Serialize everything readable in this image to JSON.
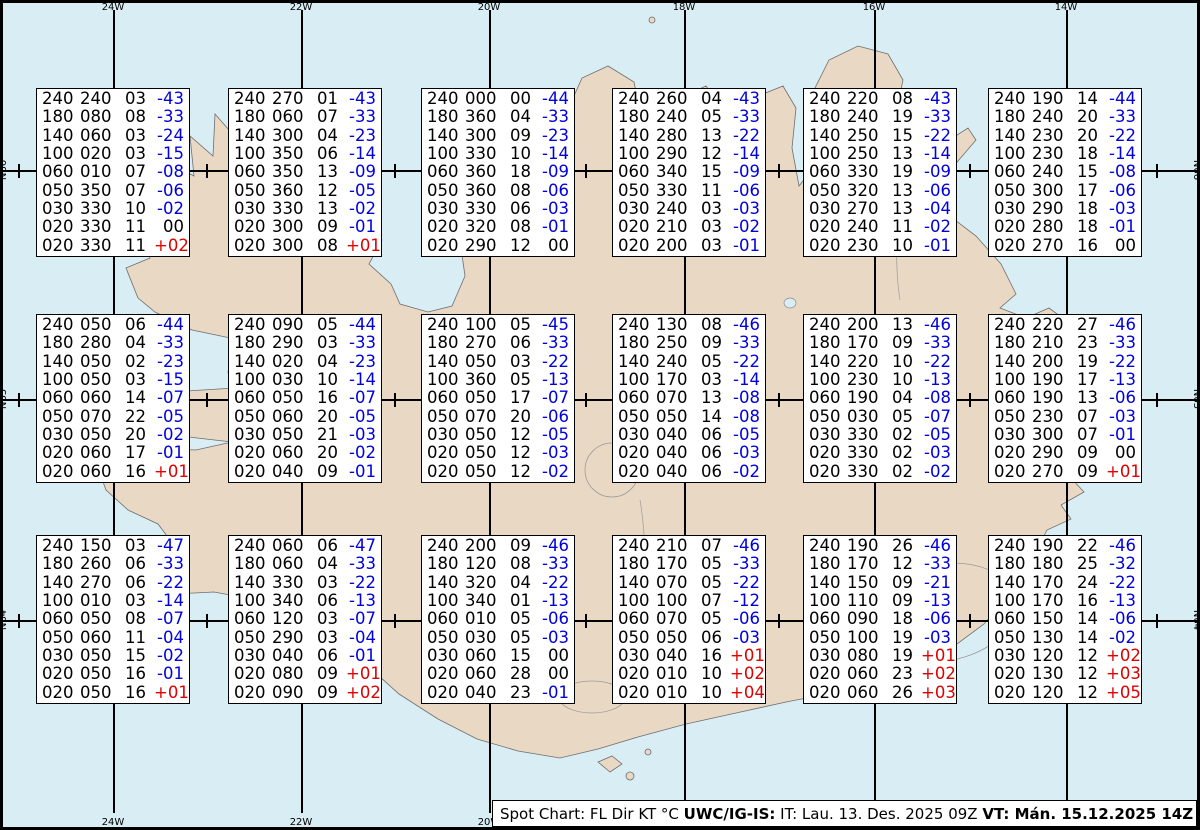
{
  "title": "Spot Chart FL Dir KT C - Iceland",
  "colors": {
    "water": "#d9edf4",
    "land": "#e9d9c4",
    "coast": "#6e6e6e",
    "line": "#000000",
    "box_background": "#ffffff",
    "temp_negative_blue": "#0000dd",
    "temp_positive_red": "#dd0000",
    "text_black": "#000000"
  },
  "graticule": {
    "meridians": [
      {
        "label": "24W",
        "x": 113
      },
      {
        "label": "22W",
        "x": 301
      },
      {
        "label": "20W",
        "x": 489
      },
      {
        "label": "18W",
        "x": 684
      },
      {
        "label": "16W",
        "x": 874
      },
      {
        "label": "14W",
        "x": 1066
      }
    ],
    "parallels": [
      {
        "label": "N66",
        "y": 170
      },
      {
        "label": "N65",
        "y": 399
      },
      {
        "label": "N64",
        "y": 620
      }
    ],
    "minor_tick_x": [
      19,
      207,
      395,
      586,
      779,
      970,
      1157
    ]
  },
  "boxes": [
    {
      "id": "r1c1",
      "x": 36,
      "y": 88,
      "rows": [
        [
          "240",
          "240",
          "03",
          "-43"
        ],
        [
          "180",
          "080",
          "08",
          "-33"
        ],
        [
          "140",
          "060",
          "03",
          "-24"
        ],
        [
          "100",
          "020",
          "03",
          "-15"
        ],
        [
          "060",
          "010",
          "07",
          "-08"
        ],
        [
          "050",
          "350",
          "07",
          "-06"
        ],
        [
          "030",
          "330",
          "10",
          "-02"
        ],
        [
          "020",
          "330",
          "11",
          "00"
        ],
        [
          "020",
          "330",
          "11",
          "+02"
        ]
      ]
    },
    {
      "id": "r1c2",
      "x": 228,
      "y": 88,
      "rows": [
        [
          "240",
          "270",
          "01",
          "-43"
        ],
        [
          "180",
          "060",
          "07",
          "-33"
        ],
        [
          "140",
          "300",
          "04",
          "-23"
        ],
        [
          "100",
          "350",
          "06",
          "-14"
        ],
        [
          "060",
          "350",
          "13",
          "-09"
        ],
        [
          "050",
          "360",
          "12",
          "-05"
        ],
        [
          "030",
          "330",
          "13",
          "-02"
        ],
        [
          "020",
          "300",
          "09",
          "-01"
        ],
        [
          "020",
          "300",
          "08",
          "+01"
        ]
      ]
    },
    {
      "id": "r1c3",
      "x": 421,
      "y": 88,
      "rows": [
        [
          "240",
          "000",
          "00",
          "-44"
        ],
        [
          "180",
          "360",
          "04",
          "-33"
        ],
        [
          "140",
          "300",
          "09",
          "-23"
        ],
        [
          "100",
          "330",
          "10",
          "-14"
        ],
        [
          "060",
          "360",
          "18",
          "-09"
        ],
        [
          "050",
          "360",
          "08",
          "-06"
        ],
        [
          "030",
          "330",
          "06",
          "-03"
        ],
        [
          "020",
          "320",
          "08",
          "-01"
        ],
        [
          "020",
          "290",
          "12",
          "00"
        ]
      ]
    },
    {
      "id": "r1c4",
      "x": 612,
      "y": 88,
      "rows": [
        [
          "240",
          "260",
          "04",
          "-43"
        ],
        [
          "180",
          "240",
          "05",
          "-33"
        ],
        [
          "140",
          "280",
          "13",
          "-22"
        ],
        [
          "100",
          "290",
          "12",
          "-14"
        ],
        [
          "060",
          "340",
          "15",
          "-09"
        ],
        [
          "050",
          "330",
          "11",
          "-06"
        ],
        [
          "030",
          "240",
          "03",
          "-03"
        ],
        [
          "020",
          "210",
          "03",
          "-02"
        ],
        [
          "020",
          "200",
          "03",
          "-01"
        ]
      ]
    },
    {
      "id": "r1c5",
      "x": 803,
      "y": 88,
      "rows": [
        [
          "240",
          "220",
          "08",
          "-43"
        ],
        [
          "180",
          "240",
          "19",
          "-33"
        ],
        [
          "140",
          "250",
          "15",
          "-22"
        ],
        [
          "100",
          "250",
          "13",
          "-14"
        ],
        [
          "060",
          "330",
          "19",
          "-09"
        ],
        [
          "050",
          "320",
          "13",
          "-06"
        ],
        [
          "030",
          "270",
          "13",
          "-04"
        ],
        [
          "020",
          "240",
          "11",
          "-02"
        ],
        [
          "020",
          "230",
          "10",
          "-01"
        ]
      ]
    },
    {
      "id": "r1c6",
      "x": 988,
      "y": 88,
      "rows": [
        [
          "240",
          "190",
          "14",
          "-44"
        ],
        [
          "180",
          "240",
          "20",
          "-33"
        ],
        [
          "140",
          "230",
          "20",
          "-22"
        ],
        [
          "100",
          "230",
          "18",
          "-14"
        ],
        [
          "060",
          "240",
          "15",
          "-08"
        ],
        [
          "050",
          "300",
          "17",
          "-06"
        ],
        [
          "030",
          "290",
          "18",
          "-03"
        ],
        [
          "020",
          "280",
          "18",
          "-01"
        ],
        [
          "020",
          "270",
          "16",
          "00"
        ]
      ]
    },
    {
      "id": "r2c1",
      "x": 36,
      "y": 314,
      "rows": [
        [
          "240",
          "050",
          "06",
          "-44"
        ],
        [
          "180",
          "280",
          "04",
          "-33"
        ],
        [
          "140",
          "050",
          "02",
          "-23"
        ],
        [
          "100",
          "050",
          "03",
          "-15"
        ],
        [
          "060",
          "060",
          "14",
          "-07"
        ],
        [
          "050",
          "070",
          "22",
          "-05"
        ],
        [
          "030",
          "050",
          "20",
          "-02"
        ],
        [
          "020",
          "060",
          "17",
          "-01"
        ],
        [
          "020",
          "060",
          "16",
          "+01"
        ]
      ]
    },
    {
      "id": "r2c2",
      "x": 228,
      "y": 314,
      "rows": [
        [
          "240",
          "090",
          "05",
          "-44"
        ],
        [
          "180",
          "290",
          "03",
          "-33"
        ],
        [
          "140",
          "020",
          "04",
          "-23"
        ],
        [
          "100",
          "030",
          "10",
          "-14"
        ],
        [
          "060",
          "050",
          "16",
          "-07"
        ],
        [
          "050",
          "060",
          "20",
          "-05"
        ],
        [
          "030",
          "050",
          "21",
          "-03"
        ],
        [
          "020",
          "060",
          "20",
          "-02"
        ],
        [
          "020",
          "040",
          "09",
          "-01"
        ]
      ]
    },
    {
      "id": "r2c3",
      "x": 421,
      "y": 314,
      "rows": [
        [
          "240",
          "100",
          "05",
          "-45"
        ],
        [
          "180",
          "270",
          "06",
          "-33"
        ],
        [
          "140",
          "050",
          "03",
          "-22"
        ],
        [
          "100",
          "360",
          "05",
          "-13"
        ],
        [
          "060",
          "050",
          "17",
          "-07"
        ],
        [
          "050",
          "070",
          "20",
          "-06"
        ],
        [
          "030",
          "050",
          "12",
          "-05"
        ],
        [
          "020",
          "050",
          "12",
          "-03"
        ],
        [
          "020",
          "050",
          "12",
          "-02"
        ]
      ]
    },
    {
      "id": "r2c4",
      "x": 612,
      "y": 314,
      "rows": [
        [
          "240",
          "130",
          "08",
          "-46"
        ],
        [
          "180",
          "250",
          "09",
          "-33"
        ],
        [
          "140",
          "240",
          "05",
          "-22"
        ],
        [
          "100",
          "170",
          "03",
          "-14"
        ],
        [
          "060",
          "070",
          "13",
          "-08"
        ],
        [
          "050",
          "050",
          "14",
          "-08"
        ],
        [
          "030",
          "040",
          "06",
          "-05"
        ],
        [
          "020",
          "040",
          "06",
          "-03"
        ],
        [
          "020",
          "040",
          "06",
          "-02"
        ]
      ]
    },
    {
      "id": "r2c5",
      "x": 803,
      "y": 314,
      "rows": [
        [
          "240",
          "200",
          "13",
          "-46"
        ],
        [
          "180",
          "170",
          "09",
          "-33"
        ],
        [
          "140",
          "220",
          "10",
          "-22"
        ],
        [
          "100",
          "230",
          "10",
          "-13"
        ],
        [
          "060",
          "190",
          "04",
          "-08"
        ],
        [
          "050",
          "030",
          "05",
          "-07"
        ],
        [
          "030",
          "330",
          "02",
          "-05"
        ],
        [
          "020",
          "330",
          "02",
          "-03"
        ],
        [
          "020",
          "330",
          "02",
          "-02"
        ]
      ]
    },
    {
      "id": "r2c6",
      "x": 988,
      "y": 314,
      "rows": [
        [
          "240",
          "220",
          "27",
          "-46"
        ],
        [
          "180",
          "210",
          "23",
          "-33"
        ],
        [
          "140",
          "200",
          "19",
          "-22"
        ],
        [
          "100",
          "190",
          "17",
          "-13"
        ],
        [
          "060",
          "190",
          "13",
          "-06"
        ],
        [
          "050",
          "230",
          "07",
          "-03"
        ],
        [
          "030",
          "300",
          "07",
          "-01"
        ],
        [
          "020",
          "290",
          "09",
          "00"
        ],
        [
          "020",
          "270",
          "09",
          "+01"
        ]
      ]
    },
    {
      "id": "r3c1",
      "x": 36,
      "y": 535,
      "rows": [
        [
          "240",
          "150",
          "03",
          "-47"
        ],
        [
          "180",
          "260",
          "06",
          "-33"
        ],
        [
          "140",
          "270",
          "06",
          "-22"
        ],
        [
          "100",
          "010",
          "03",
          "-14"
        ],
        [
          "060",
          "050",
          "08",
          "-07"
        ],
        [
          "050",
          "060",
          "11",
          "-04"
        ],
        [
          "030",
          "050",
          "15",
          "-02"
        ],
        [
          "020",
          "050",
          "16",
          "-01"
        ],
        [
          "020",
          "050",
          "16",
          "+01"
        ]
      ]
    },
    {
      "id": "r3c2",
      "x": 228,
      "y": 535,
      "rows": [
        [
          "240",
          "060",
          "06",
          "-47"
        ],
        [
          "180",
          "060",
          "04",
          "-33"
        ],
        [
          "140",
          "330",
          "03",
          "-22"
        ],
        [
          "100",
          "340",
          "06",
          "-13"
        ],
        [
          "060",
          "120",
          "03",
          "-07"
        ],
        [
          "050",
          "290",
          "03",
          "-04"
        ],
        [
          "030",
          "040",
          "06",
          "-01"
        ],
        [
          "020",
          "080",
          "09",
          "+01"
        ],
        [
          "020",
          "090",
          "09",
          "+02"
        ]
      ]
    },
    {
      "id": "r3c3",
      "x": 421,
      "y": 535,
      "rows": [
        [
          "240",
          "200",
          "09",
          "-46"
        ],
        [
          "180",
          "120",
          "08",
          "-33"
        ],
        [
          "140",
          "320",
          "04",
          "-22"
        ],
        [
          "100",
          "340",
          "01",
          "-13"
        ],
        [
          "060",
          "010",
          "05",
          "-06"
        ],
        [
          "050",
          "030",
          "05",
          "-03"
        ],
        [
          "030",
          "060",
          "15",
          "00"
        ],
        [
          "020",
          "060",
          "28",
          "00"
        ],
        [
          "020",
          "040",
          "23",
          "-01"
        ]
      ]
    },
    {
      "id": "r3c4",
      "x": 612,
      "y": 535,
      "rows": [
        [
          "240",
          "210",
          "07",
          "-46"
        ],
        [
          "180",
          "170",
          "05",
          "-33"
        ],
        [
          "140",
          "070",
          "05",
          "-22"
        ],
        [
          "100",
          "100",
          "07",
          "-12"
        ],
        [
          "060",
          "070",
          "05",
          "-06"
        ],
        [
          "050",
          "050",
          "06",
          "-03"
        ],
        [
          "030",
          "040",
          "16",
          "+01"
        ],
        [
          "020",
          "010",
          "10",
          "+02"
        ],
        [
          "020",
          "010",
          "10",
          "+04"
        ]
      ]
    },
    {
      "id": "r3c5",
      "x": 803,
      "y": 535,
      "rows": [
        [
          "240",
          "190",
          "26",
          "-46"
        ],
        [
          "180",
          "170",
          "12",
          "-33"
        ],
        [
          "140",
          "150",
          "09",
          "-21"
        ],
        [
          "100",
          "110",
          "09",
          "-13"
        ],
        [
          "060",
          "090",
          "18",
          "-06"
        ],
        [
          "050",
          "100",
          "19",
          "-03"
        ],
        [
          "030",
          "080",
          "19",
          "+01"
        ],
        [
          "020",
          "060",
          "23",
          "+02"
        ],
        [
          "020",
          "060",
          "26",
          "+03"
        ]
      ]
    },
    {
      "id": "r3c6",
      "x": 988,
      "y": 535,
      "rows": [
        [
          "240",
          "190",
          "22",
          "-46"
        ],
        [
          "180",
          "180",
          "25",
          "-32"
        ],
        [
          "140",
          "170",
          "24",
          "-22"
        ],
        [
          "100",
          "170",
          "16",
          "-13"
        ],
        [
          "060",
          "150",
          "14",
          "-06"
        ],
        [
          "050",
          "130",
          "14",
          "-02"
        ],
        [
          "030",
          "120",
          "12",
          "+02"
        ],
        [
          "020",
          "130",
          "12",
          "+03"
        ],
        [
          "020",
          "120",
          "12",
          "+05"
        ]
      ]
    }
  ],
  "footer": {
    "part1": "Spot Chart: FL Dir KT °C ",
    "part2": "UWC/IG-IS:",
    "part3": " IT: Lau. 13. Des. 2025 09Z ",
    "part4": "VT: Mán. 15.12.2025 14Z",
    "part5": " (+53 h)"
  }
}
